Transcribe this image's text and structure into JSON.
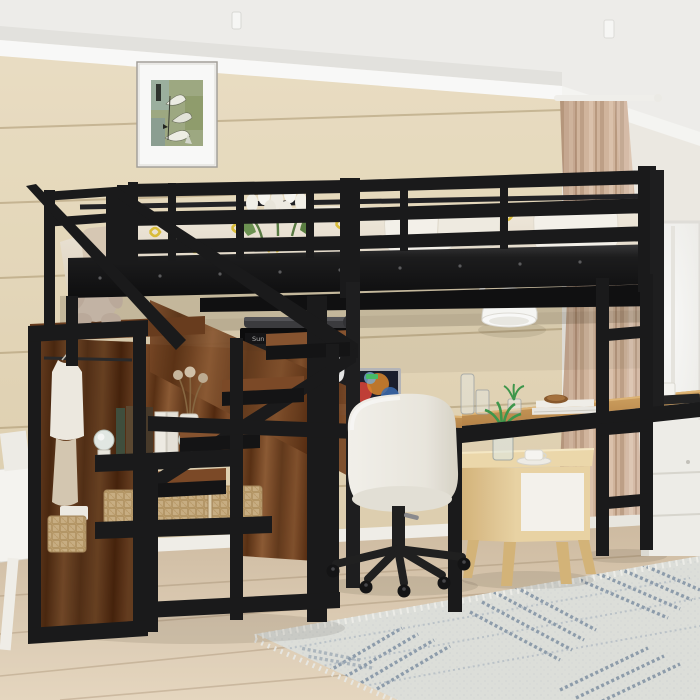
{
  "scene": {
    "type": "product lifestyle photograph",
    "description": "Black metal loft bed with storage staircase, wardrobe shelves and L-shaped desk workstation underneath, in a bedroom with wood-plank wall, window with curtain and patterned rug"
  },
  "monitor_clock": {
    "day": "Sun",
    "date": "Dec 20",
    "hour": "10",
    "minute": "30"
  },
  "objects": {
    "loft_bed": "Black metal loft bed frame with guardrails",
    "staircase": "Storage staircase with rustic wood shelves",
    "wardrobe": "Open wardrobe with hanging clothes",
    "teddy": "Plush teddy bear on stair landing",
    "tulips": "White tulip bouquet on bedding",
    "bedding": "White and beige bedding with yellow leaf pattern",
    "wall_art": "Framed green abstract sailboat print",
    "wall_lamp": "White barn-style wall lamp",
    "monitor": "Desktop monitor with flip-clock screen and light bar",
    "laptop": "Open laptop with colorful wallpaper",
    "desk": "L-shaped wooden desk with black metal frame",
    "books": "Stack of books on desk",
    "nightstand": "Light wood nightstand with white drawer",
    "vase": "Glass vase with green leaves",
    "coffee_cup": "White cup and saucer",
    "office_chair": "White swivel office chair on casters",
    "ladder": "Black metal ladder at right end of bed",
    "baskets": "Woven storage baskets on shelves",
    "globes": "Decorative glass globes with books",
    "curtain": "Beige curtain panel on rod",
    "window": "Bright white window",
    "rug": "Blue-grey patterned area rug",
    "cabinet": "White storage cabinet under right desk",
    "easel": "White easel at left edge"
  },
  "colors": {
    "wall": "#ebdfc3",
    "ceiling": "#f7f6f4",
    "metal_frame": "#1a1a1c",
    "rustic_wood": "#6f4022",
    "desk_wood": "#c9995c",
    "floor": "#ddcab1",
    "curtain": "#d3b59e",
    "rug_base": "#e4e5e1",
    "rug_pattern": "#8394a8",
    "bedding": "#efe6d7",
    "accent_yellow": "#dfc23c",
    "chair": "#f4f2ec",
    "nightstand_wood": "#e8cf9f"
  }
}
